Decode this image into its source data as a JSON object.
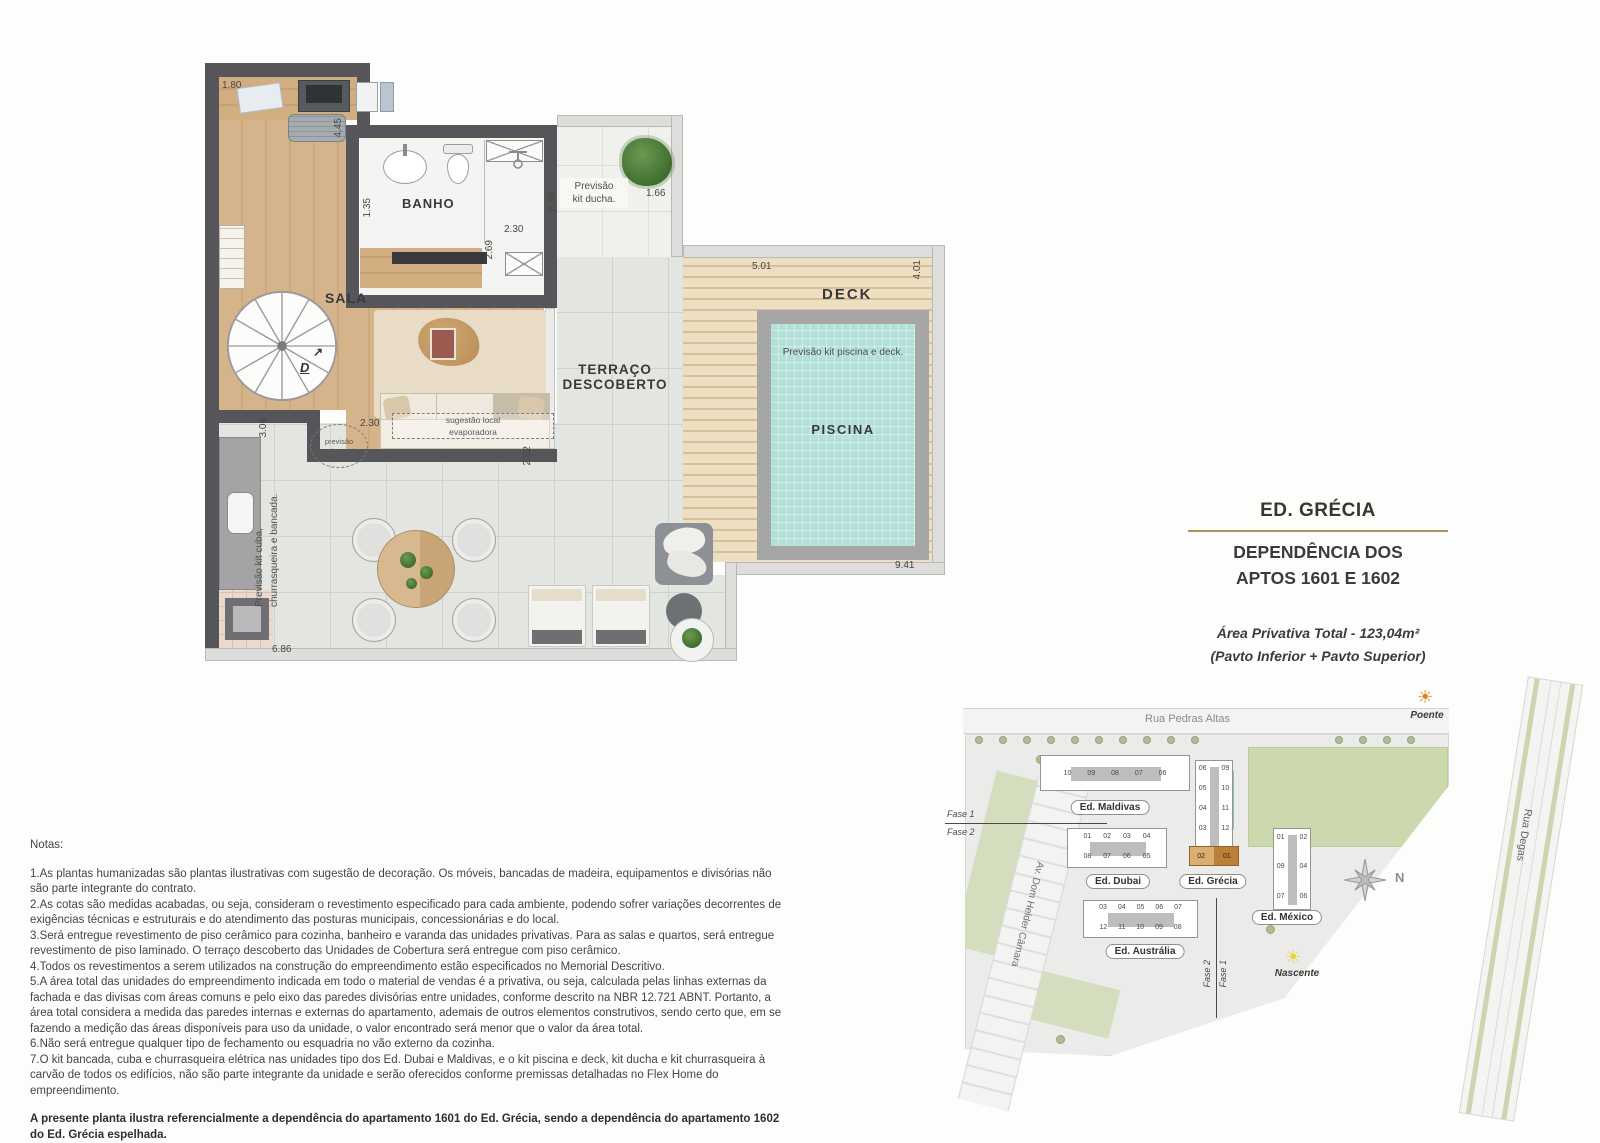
{
  "plan": {
    "labels": {
      "sala": "SALA",
      "banho": "BANHO",
      "terraco1": "TERRAÇO",
      "terraco2": "DESCOBERTO",
      "deck": "DECK",
      "piscina": "PISCINA"
    },
    "annotations": {
      "kit_ducha1": "Previsão",
      "kit_ducha2": "kit ducha.",
      "kit_piscina": "Previsão kit piscina e deck.",
      "cond1": "previsão",
      "cond2": "condensador",
      "evap1": "sugestão local",
      "evap2": "evaporadora",
      "kit_cuba1": "Previsão kit cuba,",
      "kit_cuba2": "churrasqueira e bancada.",
      "stair_d": "D",
      "stair_arrow": "↗"
    },
    "dims": {
      "d180": "1.80",
      "d445": "4.45",
      "d135": "1.35",
      "d230_banho": "2.30",
      "d269": "2.69",
      "d686_v": "6.86",
      "d166": "1.66",
      "d501": "5.01",
      "d401": "4.01",
      "d941": "9.41",
      "d306": "3.06",
      "d230_sala": "2.30",
      "d252": "2.52",
      "d686_b": "6.86"
    }
  },
  "title_block": {
    "building": "ED. GRÉCIA",
    "line1": "DEPENDÊNCIA DOS",
    "line2": "APTOS 1601 E 1602",
    "area": "Área Privativa Total - 123,04m²",
    "floors": "(Pavto Inferior + Pavto Superior)"
  },
  "site_map": {
    "streets": {
      "top": "Rua Pedras Altas",
      "left": "Av. Dom Helder Câmara",
      "right": "Rua Degas"
    },
    "suns": {
      "west": "Poente",
      "east": "Nascente"
    },
    "compass_n": "N",
    "phase": {
      "fase1": "Fase 1",
      "fase2": "Fase 2"
    },
    "buildings": [
      {
        "name": "Ed. Maldivas",
        "rows": [
          "10 09 08 07 06"
        ]
      },
      {
        "name": "Ed. Dubai",
        "rows": [
          "01 02 03 04",
          "08 07 06 05"
        ]
      },
      {
        "name": "Ed. Grécia",
        "rows": [
          "06 09",
          "05 10",
          "04 11",
          "03 12"
        ],
        "highlight_row": "02 01"
      },
      {
        "name": "Ed. México",
        "rows": [
          "01 02",
          "09 04",
          "07 06"
        ]
      },
      {
        "name": "Ed. Austrália",
        "rows": [
          "03 04 05 06 07",
          "12 11 10 09 08"
        ]
      }
    ]
  },
  "notes": {
    "heading": "Notas:",
    "items": [
      "1.As plantas humanizadas são plantas ilustrativas com sugestão de decoração. Os móveis, bancadas de madeira, equipamentos e divisórias não são parte integrante do contrato.",
      "2.As cotas são medidas acabadas, ou seja, consideram o revestimento especificado para cada ambiente, podendo sofrer variações decorrentes de exigências técnicas e estruturais e do atendimento das posturas municipais, concessionárias e do local.",
      "3.Será entregue revestimento de piso cerâmico para cozinha, banheiro e varanda das unidades privativas. Para as salas e quartos, será entregue revestimento de piso laminado. O terraço descoberto das Unidades de Cobertura será entregue com piso cerâmico.",
      "4.Todos os revestimentos a serem utilizados na construção do empreendimento estão especificados no Memorial Descritivo.",
      "5.A área total das unidades do empreendimento indicada em todo o material de vendas é a privativa, ou seja, calculada pelas linhas externas da fachada e das divisas com áreas comuns e pelo eixo das paredes divisórias entre unidades, conforme descrito na NBR 12.721 ABNT. Portanto, a área total considera a medida das paredes internas e externas do apartamento, ademais de outros elementos construtivos, sendo certo que, em se fazendo a medição das áreas disponíveis para uso da unidade, o valor encontrado será menor que o valor da área total.",
      "6.Não será entregue qualquer tipo de fechamento ou esquadria no vão externo da cozinha.",
      "7.O kit bancada, cuba e churrasqueira elétrica nas unidades tipo dos Ed. Dubai e Maldivas, e o kit piscina e deck, kit ducha e kit churrasqueira à carvão de todos os edifícios, não são parte integrante da unidade e serão oferecidos conforme premissas detalhadas no Flex Home do empreendimento."
    ],
    "footer": "A presente planta ilustra referencialmente a dependência do apartamento 1601 do Ed. Grécia, sendo a dependência do apartamento 1602 do Ed. Grécia espelhada."
  },
  "colors": {
    "wall": "#55555a",
    "wood": "#d6b48b",
    "tile": "#e3e6e0",
    "deck": "#e6d2ab",
    "pool": "#b4e0da",
    "accent_gold": "#ab9458",
    "unit_highlight": "#bb8038",
    "sun_west": "#e07f28",
    "sun_east": "#ead32a"
  }
}
